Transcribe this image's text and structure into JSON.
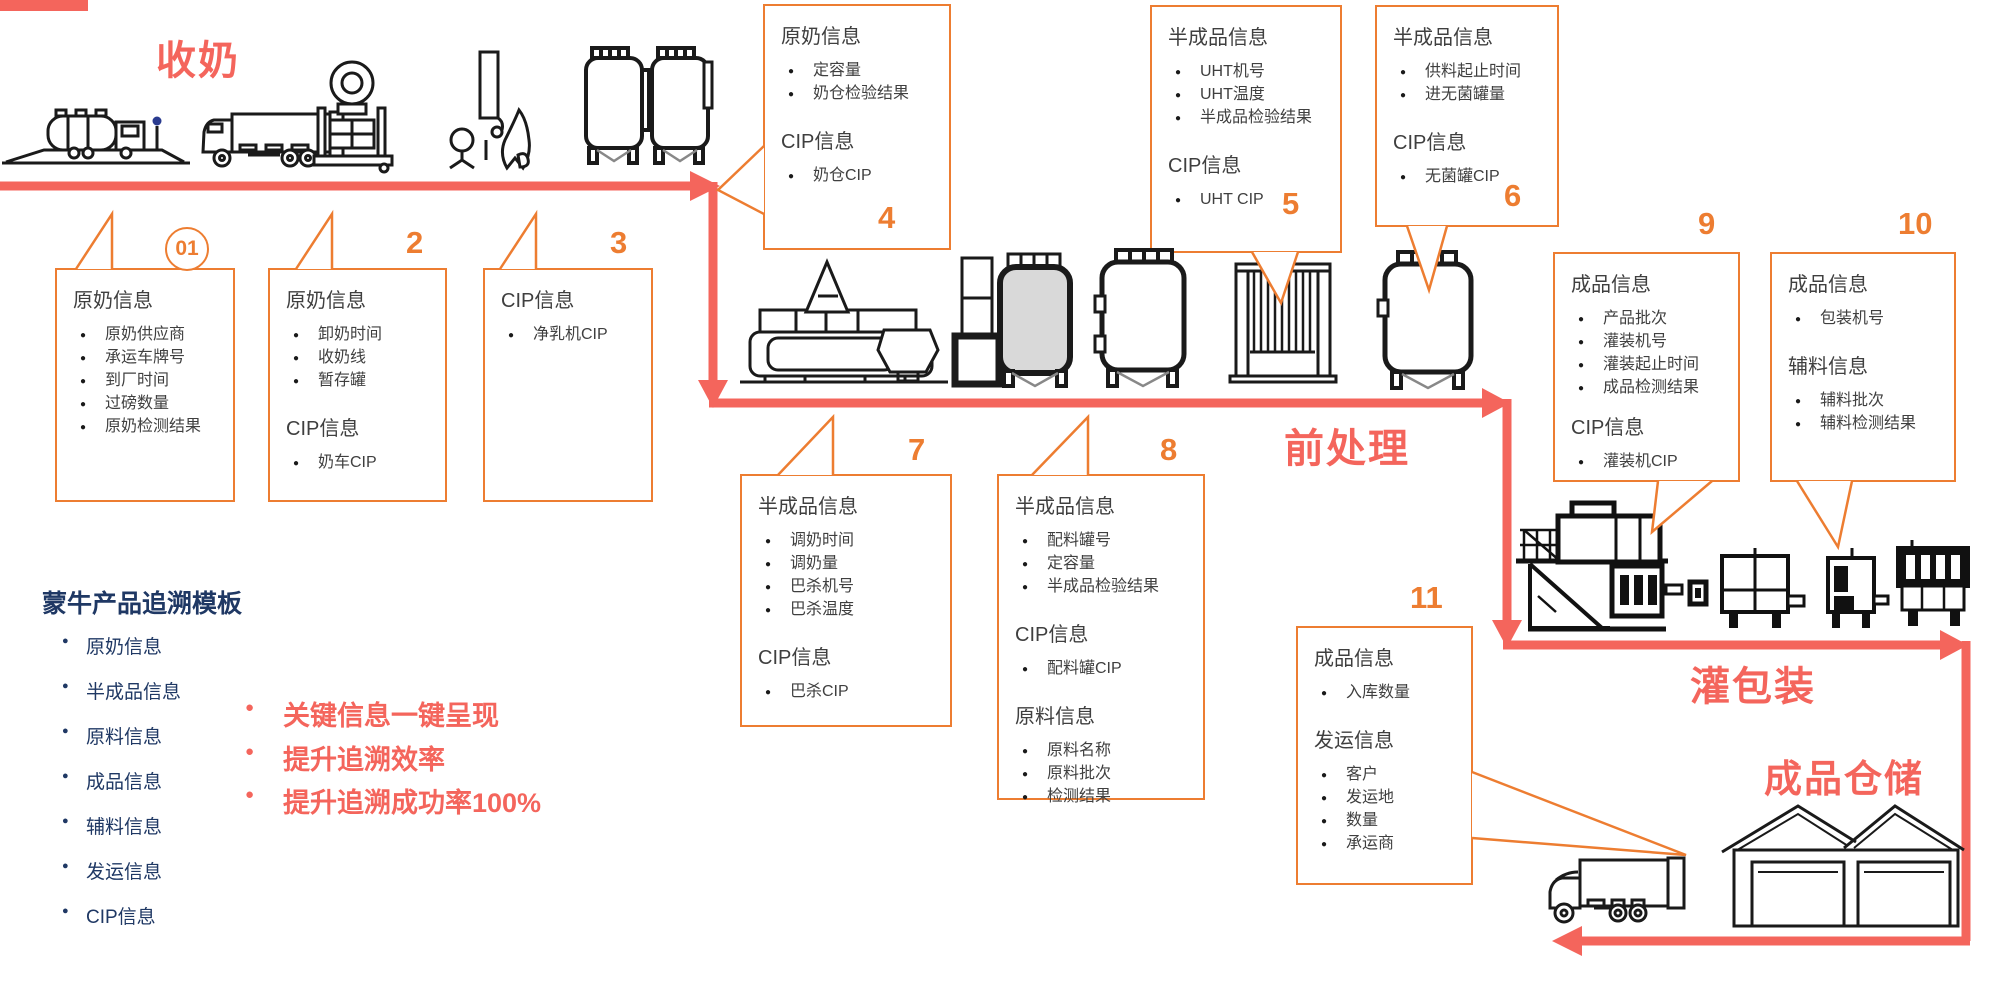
{
  "colors": {
    "red": "#F4655C",
    "orange": "#ED7D31",
    "navy": "#1F3864",
    "ink": "#3F3F3F",
    "icon_line": "#1A1A1A",
    "tank_gray": "#D9D9D9"
  },
  "stages": {
    "collect": "收奶",
    "pretreat": "前处理",
    "fill_pack": "灌包装",
    "warehouse": "成品仓储"
  },
  "left_panel": {
    "title": "蒙牛产品追溯模板",
    "items": [
      "原奶信息",
      "半成品信息",
      "原料信息",
      "成品信息",
      "辅料信息",
      "发运信息",
      "CIP信息"
    ]
  },
  "highlights": [
    "关键信息一键呈现",
    "提升追溯效率",
    "提升追溯成功率100%"
  ],
  "boxes": {
    "b1": {
      "number": "01",
      "sections": [
        {
          "title": "原奶信息",
          "items": [
            "原奶供应商",
            "承运车牌号",
            "到厂时间",
            "过磅数量",
            "原奶检测结果"
          ]
        }
      ]
    },
    "b2": {
      "number": "2",
      "sections": [
        {
          "title": "原奶信息",
          "items": [
            "卸奶时间",
            "收奶线",
            "暂存罐"
          ]
        },
        {
          "title": "CIP信息",
          "items": [
            "奶车CIP"
          ]
        }
      ]
    },
    "b3": {
      "number": "3",
      "sections": [
        {
          "title": "CIP信息",
          "items": [
            "净乳机CIP"
          ]
        }
      ]
    },
    "b4": {
      "number": "4",
      "sections": [
        {
          "title": "原奶信息",
          "items": [
            "定容量",
            "奶仓检验结果"
          ]
        },
        {
          "title": "CIP信息",
          "items": [
            "奶仓CIP"
          ]
        }
      ]
    },
    "b5": {
      "number": "5",
      "sections": [
        {
          "title": "半成品信息",
          "items": [
            "UHT机号",
            "UHT温度",
            "半成品检验结果"
          ]
        },
        {
          "title": "CIP信息",
          "items": [
            "UHT CIP"
          ]
        }
      ]
    },
    "b6": {
      "number": "6",
      "sections": [
        {
          "title": "半成品信息",
          "items": [
            "供料起止时间",
            "进无菌罐量"
          ]
        },
        {
          "title": "CIP信息",
          "items": [
            "无菌罐CIP"
          ]
        }
      ]
    },
    "b7": {
      "number": "7",
      "sections": [
        {
          "title": "半成品信息",
          "items": [
            "调奶时间",
            "调奶量",
            "巴杀机号",
            "巴杀温度"
          ]
        },
        {
          "title": "CIP信息",
          "items": [
            "巴杀CIP"
          ]
        }
      ]
    },
    "b8": {
      "number": "8",
      "sections": [
        {
          "title": "半成品信息",
          "items": [
            "配料罐号",
            "定容量",
            "半成品检验结果"
          ]
        },
        {
          "title": "CIP信息",
          "items": [
            "配料罐CIP"
          ]
        },
        {
          "title": "原料信息",
          "items": [
            "原料名称",
            "原料批次",
            "检测结果"
          ]
        }
      ]
    },
    "b9": {
      "number": "9",
      "sections": [
        {
          "title": "成品信息",
          "items": [
            "产品批次",
            "灌装机号",
            "灌装起止时间",
            "成品检测结果"
          ]
        },
        {
          "title": "CIP信息",
          "items": [
            "灌装机CIP"
          ]
        }
      ]
    },
    "b10": {
      "number": "10",
      "sections": [
        {
          "title": "成品信息",
          "items": [
            "包装机号"
          ]
        },
        {
          "title": "辅料信息",
          "items": [
            "辅料批次",
            "辅料检测结果"
          ]
        }
      ]
    },
    "b11": {
      "number": "11",
      "sections": [
        {
          "title": "成品信息",
          "items": [
            "入库数量"
          ]
        },
        {
          "title": "发运信息",
          "items": [
            "客户",
            "发运地",
            "数量",
            "承运商"
          ]
        }
      ]
    }
  },
  "icons": {
    "stage1": [
      "milk-tanker-weighbridge-icon",
      "milk-truck-icon",
      "platform-scale-icon",
      "milk-separator-icon",
      "raw-milk-silos-icon"
    ],
    "stage2": [
      "pasteurizer-line-icon",
      "mixing-tank-icon",
      "storage-tank-icon",
      "uht-plate-exchanger-icon",
      "aseptic-tank-icon"
    ],
    "stage3": [
      "filling-machine-icon",
      "conveyor-cart-icon",
      "labeling-machine-icon",
      "carton-packer-icon"
    ],
    "stage4": [
      "delivery-truck-icon",
      "warehouse-icon"
    ]
  }
}
